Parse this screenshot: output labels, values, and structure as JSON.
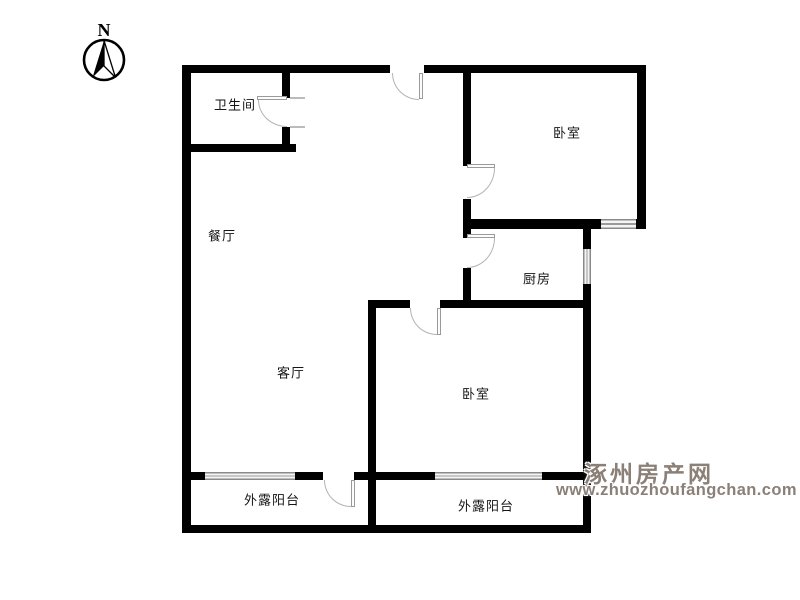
{
  "compass": {
    "label": "N"
  },
  "rooms": [
    {
      "id": "bathroom",
      "label": "卫生间"
    },
    {
      "id": "dining-room",
      "label": "餐厅"
    },
    {
      "id": "living-room",
      "label": "客厅"
    },
    {
      "id": "bedroom-top",
      "label": "卧室"
    },
    {
      "id": "kitchen",
      "label": "厨房"
    },
    {
      "id": "bedroom-bottom",
      "label": "卧室"
    },
    {
      "id": "balcony-left",
      "label": "外露阳台"
    },
    {
      "id": "balcony-right",
      "label": "外露阳台"
    }
  ],
  "watermark": {
    "site_name": "涿州房产网",
    "site_url": "www.zhuozhoufangchan.com",
    "color": "#8b8078"
  },
  "colors": {
    "wall": "#010101",
    "door_swing": "#b3b3b3",
    "window_frame": "#8a8a8a",
    "window_fill": "#f4f4f4"
  }
}
